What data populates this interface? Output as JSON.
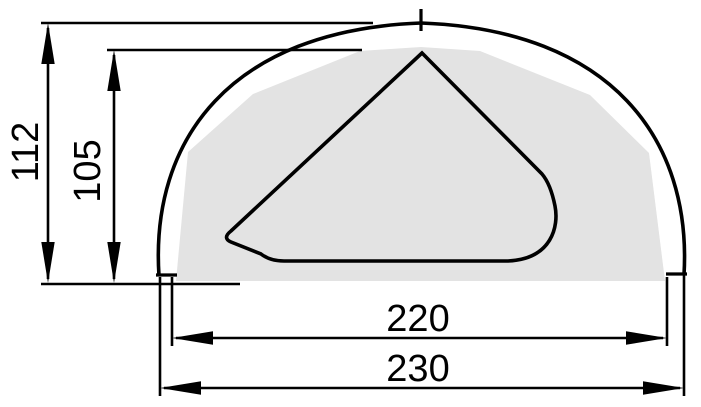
{
  "drawing": {
    "dimensions": {
      "outer_height": "112",
      "inner_height": "105",
      "inner_width": "220",
      "outer_width": "230"
    },
    "colors": {
      "line": "#000000",
      "shaded_region": "#e3e3e3",
      "background": "#ffffff"
    }
  }
}
